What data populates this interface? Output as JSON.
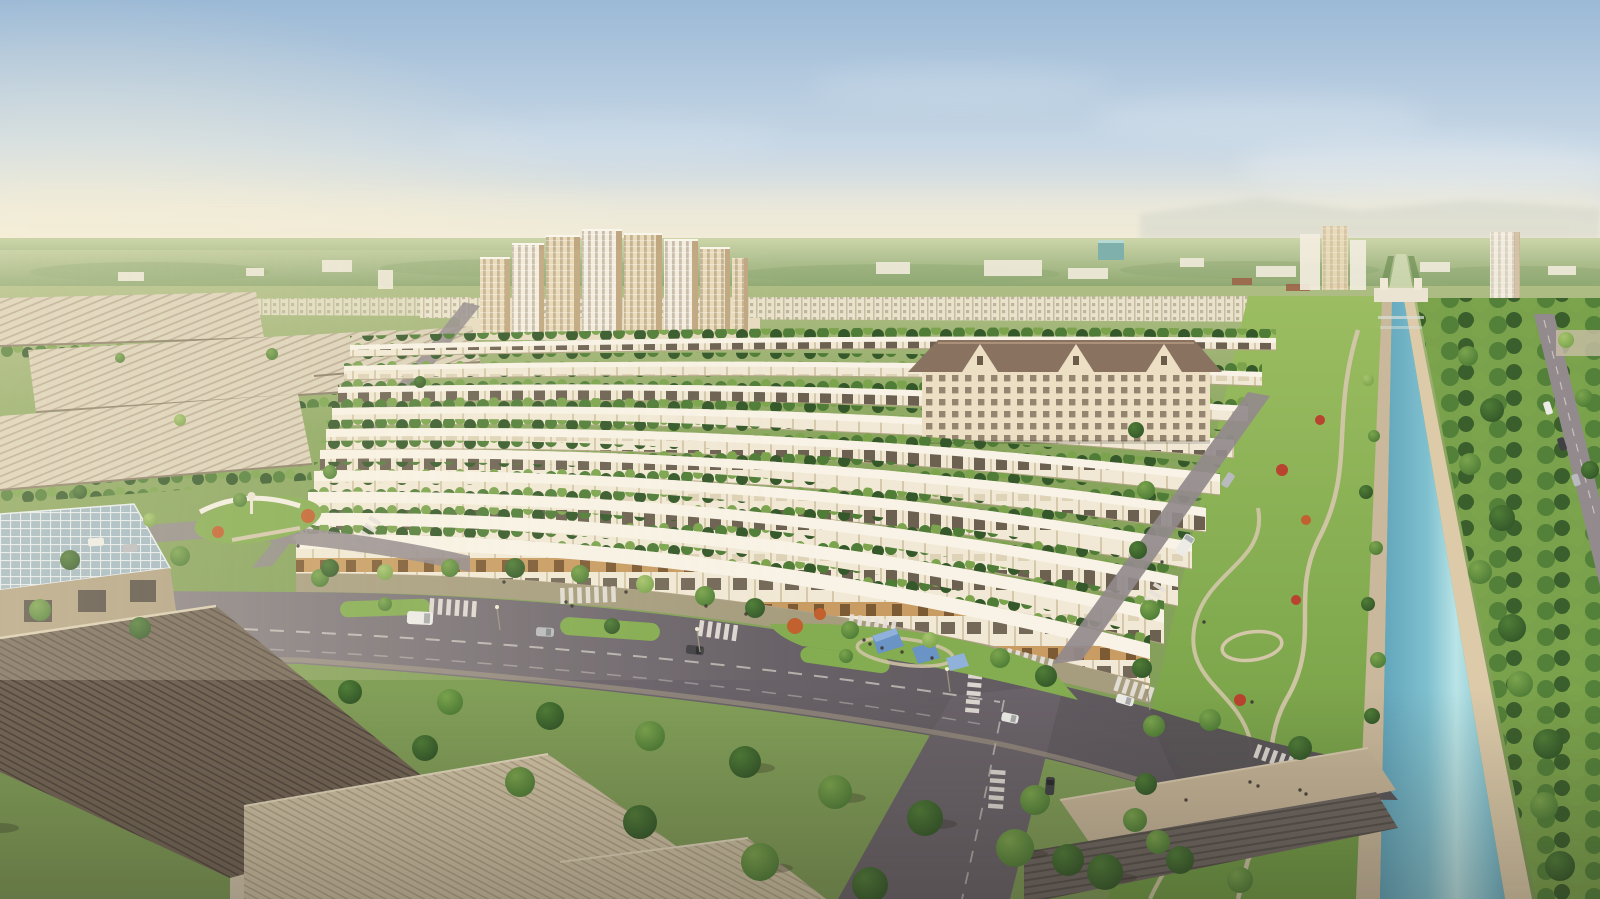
{
  "meta": {
    "description": "Aerial golden-hour architectural rendering of a master-planned township: fanned rows of white townhouses with roof terraces, a cream high-rise apartment cluster, a brown-roofed mid-rise block, a tree-lined blue canal flanked by linear parks with winding paths, wide boulevards with zebra crossings and median islands, a playground with blue shade canopies, and an industrial park of white ridged warehouses in the left foreground.",
    "scene_type": "real-estate masterplan rendering",
    "time_of_day": "late afternoon / golden hour",
    "visible_text": "none"
  },
  "scene": {
    "regions": [
      {
        "name": "sky",
        "detail": "pale blue sky fading to warm haze at the horizon, soft clouds, warm glow from the left"
      },
      {
        "name": "tower-cluster",
        "detail": "about 8 cream and white residential high-rise towers near the horizon"
      },
      {
        "name": "distant-towers-right",
        "detail": "two hazy tower groups on the right horizon and a small teal glass building"
      },
      {
        "name": "townhouse-rows",
        "detail": "about 10 fanned rows of white flat-roof townhouses with trees between rows"
      },
      {
        "name": "shophouse-row",
        "detail": "front row of shophouses with warm lit ground floors facing the boulevard"
      },
      {
        "name": "apartment-building",
        "detail": "five-storey cream mid-rise with brown mansard roof and gables"
      },
      {
        "name": "canal",
        "detail": "long straight blue canal receding to the horizon with stone embankments and a head gate"
      },
      {
        "name": "linear-park",
        "detail": "green park strip with winding paths, loop trails and flower beds west of the canal"
      },
      {
        "name": "right-tree-avenue",
        "detail": "dense double tree rows and a small road east of the canal"
      },
      {
        "name": "boulevard",
        "detail": "wide curving boulevard with zebra crossings, median islands, cars and street trees"
      },
      {
        "name": "playground-park",
        "detail": "pocket park with blue shade canopies and orange flowering trees"
      },
      {
        "name": "warehouse-district",
        "detail": "white ridged warehouse roofs of an industrial park, upper left"
      },
      {
        "name": "foreground-industrial",
        "detail": "large dark corrugated roofs, a glass-grid atrium roof and stone walls, bottom left"
      },
      {
        "name": "promenade",
        "detail": "tan pedestrian promenade and amphitheatre steps meeting the canal, bottom right"
      }
    ],
    "counts": {
      "main_towers": 8,
      "townhouse_rows": 10,
      "canopies": 3,
      "crosswalk_groups": 12
    }
  },
  "palette": {
    "sky_top": "#9bb9d6",
    "sky_mid": "#c7d7e5",
    "horizon": "#f2ecd8",
    "glow": "#fdf3d4",
    "cloud": "#ffffff",
    "mountain": "#c9cfc8",
    "dist_tree_top": "#ccd5a9",
    "dist_tree": "#90a973",
    "dist_bldg": "#efe9da",
    "ground": "#8aa65e",
    "grass_bright": "#9cbd62",
    "park_green": "#84ac50",
    "tree_green": "#4f7d37",
    "tree_dark": "#345829",
    "tree_light": "#7ba44d",
    "leaf_pale": "#a8c46e",
    "autumn": "#c2602f",
    "flower": "#b8432f",
    "house_wall": "#f1e9d5",
    "house_div": "#d6c9ab",
    "house_win": "#55493a",
    "roof_white": "#f8f3e6",
    "shop_base": "#c89c62",
    "row_shadow": "#b3a587",
    "tower_cream": "#e9dab9",
    "tower_white": "#f3ede0",
    "tower_shadow": "#c0a781",
    "tower_win": "#8a755a",
    "teal_glass": "#7fb0ab",
    "apt_wall": "#ecdfc4",
    "apt_roof": "#8a7260",
    "apt_roof_hi": "#aa9078",
    "water_edge": "#4f93ad",
    "water_mid": "#7fc0cf",
    "water_hi": "#b9e4e6",
    "embank": "#c9b89b",
    "embank_sun": "#dccaa9",
    "road": "#6a6369",
    "road_light": "#928a8c",
    "road_dark": "#595459",
    "lane": "#dfdad1",
    "zebra": "#e7e2da",
    "sidewalk": "#a99c81",
    "wh_roof": "#dcd2ba",
    "wh_line": "#b2a388",
    "wh_shadow": "#8b7e69",
    "dark_roof": "#746656",
    "dark_roof_line": "#544940",
    "tan_roof": "#cfc2a5",
    "tan_roof_line": "#b1a286",
    "stone": "#b2a183",
    "glass": "#a1b7c2",
    "glass_line": "#e9eef1",
    "path": "#d3c6a9",
    "canopy": "#6a93c6",
    "canopy_hi": "#90b1d9",
    "white": "#f0ece5",
    "wall_cream": "#d8cbb0",
    "wall_shadow": "#b9ab90",
    "win_dark": "#46403a",
    "car_white": "#ecebe6",
    "car_dark": "#414145",
    "car_silver": "#b9babd",
    "people": "#3a332d",
    "red_roof": "#9c6047",
    "shadow": "rgba(45,40,33,0.28)"
  }
}
